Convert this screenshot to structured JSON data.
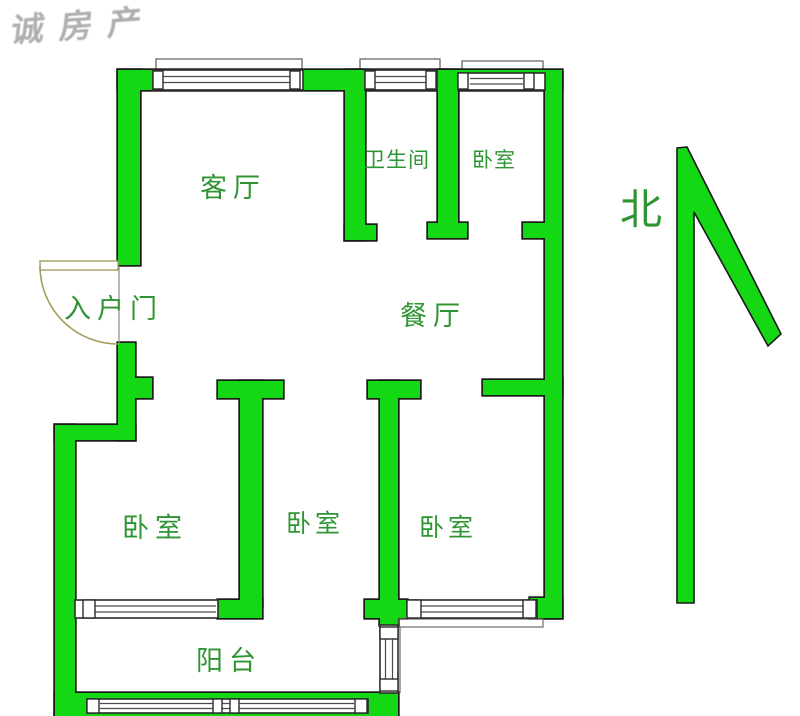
{
  "watermark": "诚房产",
  "compass": {
    "label": "北"
  },
  "labels": {
    "living_room": "客厅",
    "bathroom": "卫生间",
    "bedroom_top": "卧室",
    "entry_door": "入户门",
    "dining_room": "餐厅",
    "bedroom_left": "卧室",
    "bedroom_middle": "卧室",
    "bedroom_right": "卧室",
    "balcony": "阳台"
  },
  "colors": {
    "wall": "#13d813",
    "label_text": "#2f9432",
    "door": "#a79d5f",
    "watermark": "#8f8f8f"
  }
}
